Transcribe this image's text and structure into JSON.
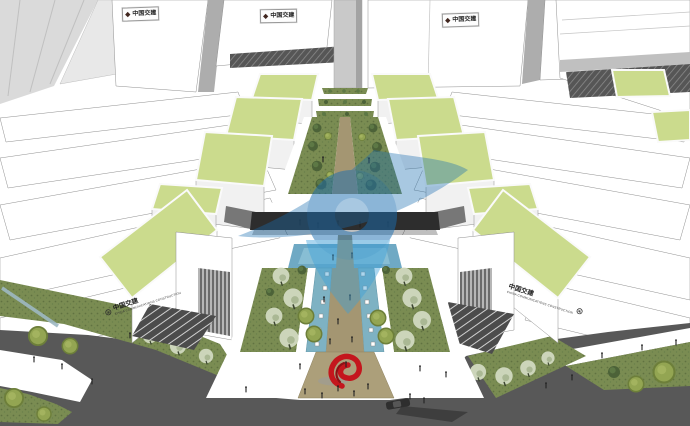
{
  "signs": {
    "tower": {
      "logo_glyph": "◆",
      "label": "中国交建"
    },
    "podium_left": {
      "emblem_glyph": "⊛",
      "label": "中国交建",
      "sublabel": "CHINA COMMUNICATIONS CONSTRUCTION"
    },
    "podium_right": {
      "emblem_glyph": "⊛",
      "label": "中国交建",
      "sublabel": "CHINA COMMUNICATIONS CONSTRUCTION"
    }
  },
  "watermark": {
    "shape": "blue pin-and-swoosh logo"
  },
  "colors": {
    "buildingWhite": "#ffffff",
    "faceShade": "#f1f1f1",
    "lightGray": "#dadada",
    "coreGray": "#adadad",
    "edgeGray": "#8f8f8f",
    "greenRoof": "#cbdb8d",
    "lawn": "#7a8c52",
    "lawnDark": "#4c5c33",
    "water": "#7eb2c3",
    "waterPlaza": "#6fa9c4",
    "pathTan": "#a49672",
    "plazaTan": "#ac9f7a",
    "road": "#585858",
    "bridgeDark": "#2d2d2d",
    "treeDark": "#4c6238",
    "treeLight": "#5d7845",
    "blossom": "#ccd5ba",
    "shrubOlive": "#93a552",
    "shrubRing": "#6d7f3a",
    "sculptureRed": "#c4161d",
    "sculptureRedDark": "#8e1015",
    "watermarkBlue": "#1a6db0",
    "watermarkBlueLight": "#3ba0d8",
    "personDark": "#222222",
    "rampDark": "#4c4c4c",
    "rampStripe": "#d0d0d0"
  }
}
